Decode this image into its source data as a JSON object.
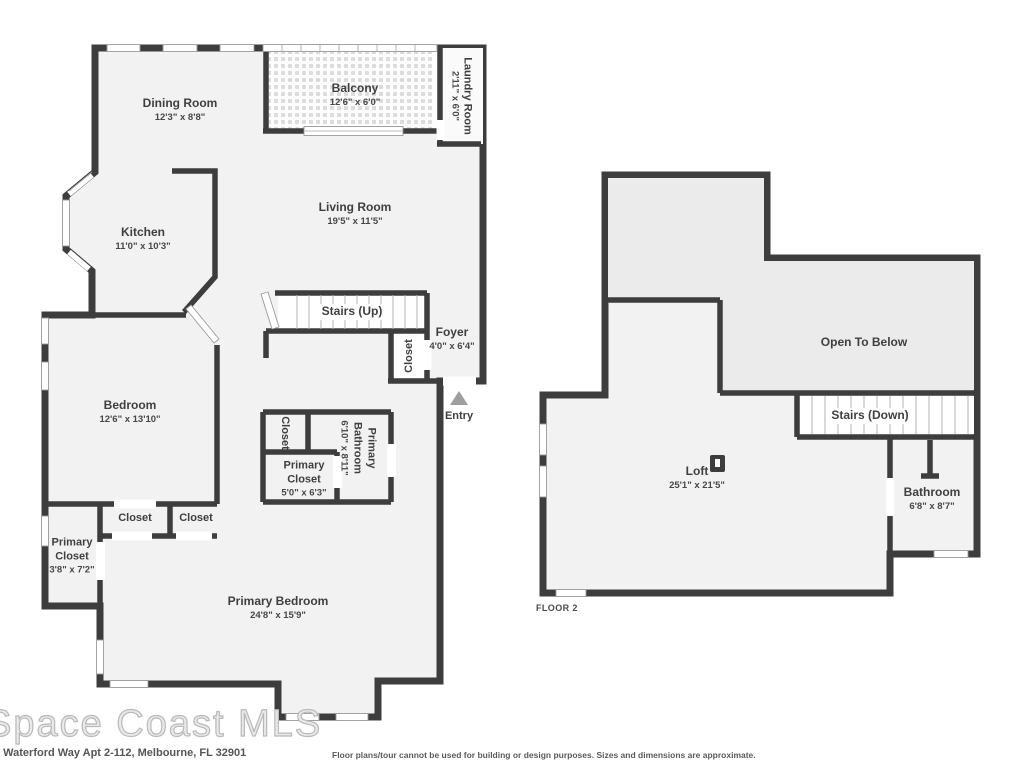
{
  "colors": {
    "wall": "#3d3d3d",
    "room_fill": "#f2f2f2",
    "open_fill": "#ebebeb",
    "entry_arrow": "#9e9e9e"
  },
  "floor1": {
    "dining": {
      "name": "Dining Room",
      "dim": "12'3\" x 8'8\""
    },
    "balcony": {
      "name": "Balcony",
      "dim": "12'6\" x 6'0\""
    },
    "laundry": {
      "name": "Laundry Room",
      "dim": "2'11\" x 6'0\""
    },
    "living": {
      "name": "Living Room",
      "dim": "19'5\" x 11'5\""
    },
    "kitchen": {
      "name": "Kitchen",
      "dim": "11'0\" x 10'3\""
    },
    "stairs": {
      "name": "Stairs (Up)"
    },
    "foyer": {
      "name": "Foyer",
      "dim": "4'0\" x 6'4\""
    },
    "closet_foyer": {
      "name": "Closet"
    },
    "entry": {
      "name": "Entry"
    },
    "bedroom": {
      "name": "Bedroom",
      "dim": "12'6\" x 13'10\""
    },
    "closet_hall": {
      "name": "Closet"
    },
    "primary_bathroom": {
      "name": "Primary Bathroom",
      "dim": "6'10\" x 8'11\""
    },
    "primary_closet_small": {
      "name": "Primary Closet",
      "dim": "5'0\" x 6'3\""
    },
    "closet_a": {
      "name": "Closet"
    },
    "closet_b": {
      "name": "Closet"
    },
    "primary_closet_large": {
      "name": "Primary Closet",
      "dim": "3'8\" x 7'2\""
    },
    "primary_bedroom": {
      "name": "Primary Bedroom",
      "dim": "24'8\" x 15'9\""
    }
  },
  "floor2": {
    "open_to_below": {
      "name": "Open To Below"
    },
    "stairs": {
      "name": "Stairs (Down)"
    },
    "loft": {
      "name": "Loft",
      "dim": "25'1\" x 21'5\""
    },
    "bathroom": {
      "name": "Bathroom",
      "dim": "6'8\" x 8'7\""
    },
    "floor_label": "FLOOR 2"
  },
  "footer": {
    "watermark": "Space Coast MLS",
    "address": "e Waterford Way Apt 2-112, Melbourne, FL 32901",
    "disclaimer": "Floor plans/tour cannot be used for building or design purposes. Sizes and dimensions are approximate."
  }
}
